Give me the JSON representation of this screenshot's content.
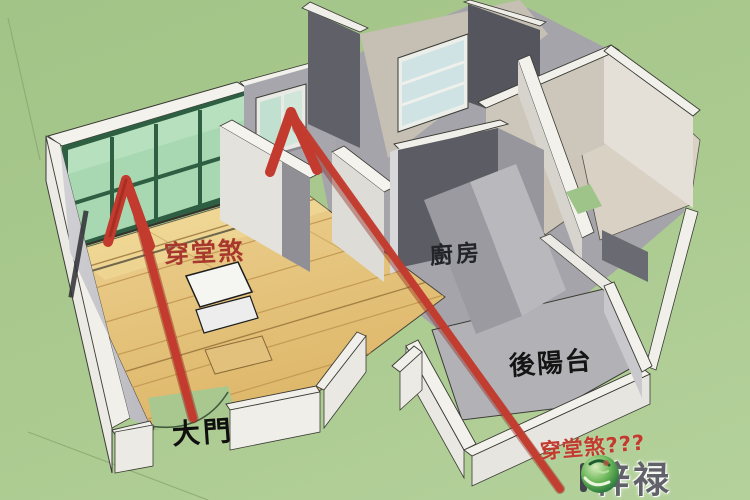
{
  "scene": {
    "description": "3D isometric apartment floor plan on grass ground",
    "colors": {
      "background_green": "#a9c98e",
      "arrow_red": "#c33b2e",
      "window_glass_green": "#a8d8b2",
      "wood_floor": "#e6c77e",
      "kitchen_wall_dark": "#5c5c64",
      "wall_white": "#f1f0ea"
    }
  },
  "labels": {
    "hall_sha_floor": {
      "text": "穿堂煞",
      "color": "#a8382d"
    },
    "kitchen": {
      "text": "廚房",
      "color": "#23232a"
    },
    "back_balcony": {
      "text": "後陽台",
      "color": "#141414"
    },
    "main_door": {
      "text": "大門",
      "color": "#0f0f0f"
    },
    "hall_sha_query": {
      "text": "穿堂煞???",
      "color": "#c23b2e"
    }
  },
  "watermark": {
    "brand_name": "梓禄",
    "logo_icon": "leaf-globe-logo-icon"
  }
}
